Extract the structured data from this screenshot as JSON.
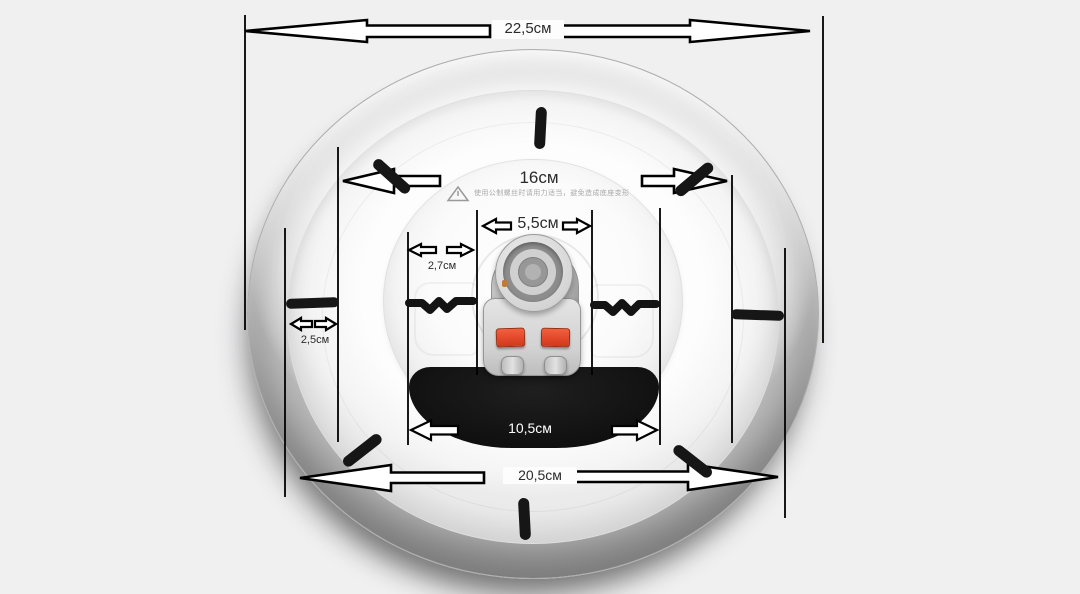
{
  "product": {
    "description_label": "ceiling-lamp-base-dimension-diagram"
  },
  "measurements": {
    "overall_diameter": {
      "label": "22,5см"
    },
    "mount_span": {
      "label": "16см"
    },
    "connector_width": {
      "label": "5,5см"
    },
    "connector_offset": {
      "label": "2,7см"
    },
    "rim_width": {
      "label": "2,5см"
    },
    "cutout_width": {
      "label": "10,5см"
    },
    "base_diameter": {
      "label": "20,5см"
    }
  },
  "warning": {
    "text": "使用公制螺丝时请用力适当，避免造成底座变形"
  },
  "colors": {
    "background": "#f0f0f1",
    "dimension_line": "#000000",
    "arrow_fill": "#ffffff",
    "tick_mark": "#161616",
    "cutout": "#121212",
    "button_red": "#e2482b",
    "label_text": "#2b2b2b",
    "warning_text": "#a9a9a9"
  }
}
